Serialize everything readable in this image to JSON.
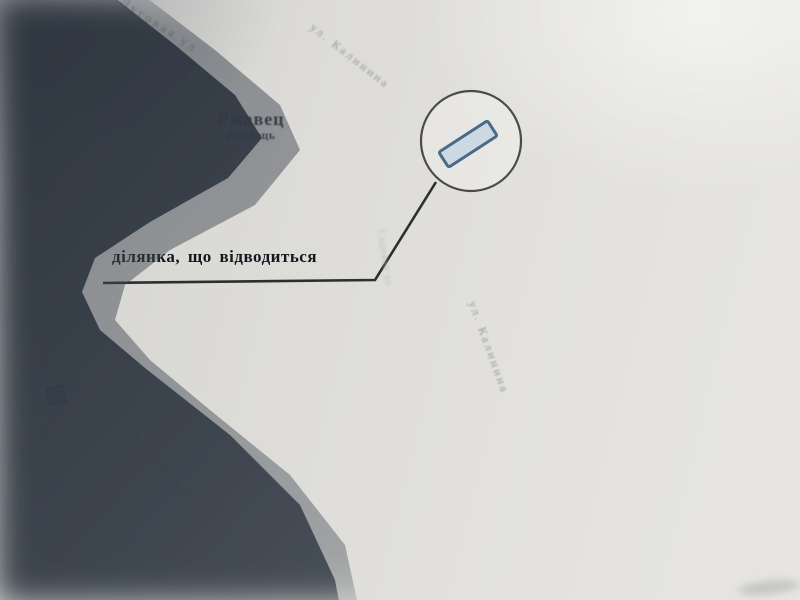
{
  "photo": {
    "description": "photograph of a printed cadastral map with camera shadow over lower-left area"
  },
  "settlement": {
    "name_ru": "Ржавец",
    "name_uk": "Ржавець"
  },
  "callout": {
    "label": "ділянка, що відводиться"
  },
  "streets": [
    {
      "id": "lugovaya",
      "label": "Луговая ул"
    },
    {
      "id": "kalinina-upper",
      "label": "ул. Калинина"
    },
    {
      "id": "sadovaya",
      "label": "Садовая ул"
    },
    {
      "id": "kalinina-lower",
      "label": "ул. Калинина"
    },
    {
      "id": "kolkhoznaya",
      "label": "Колхозная ул"
    },
    {
      "id": "sovetskaya",
      "label": "Советская ул"
    }
  ],
  "map_symbols": {
    "parcel": {
      "shape": "rotated rectangle inside highlight circle",
      "fill": "#ccd9e3",
      "stroke": "#4a6b88"
    },
    "highlight_circle_stroke": "#4b4b49",
    "leader_line_color": "#2b2e33",
    "building_marker_color": "#3f6fae"
  },
  "colors": {
    "paper": "#e0dfdb",
    "shadow_dark": "#3c444e",
    "callout_text": "#15181e",
    "street_label": "#979991"
  }
}
